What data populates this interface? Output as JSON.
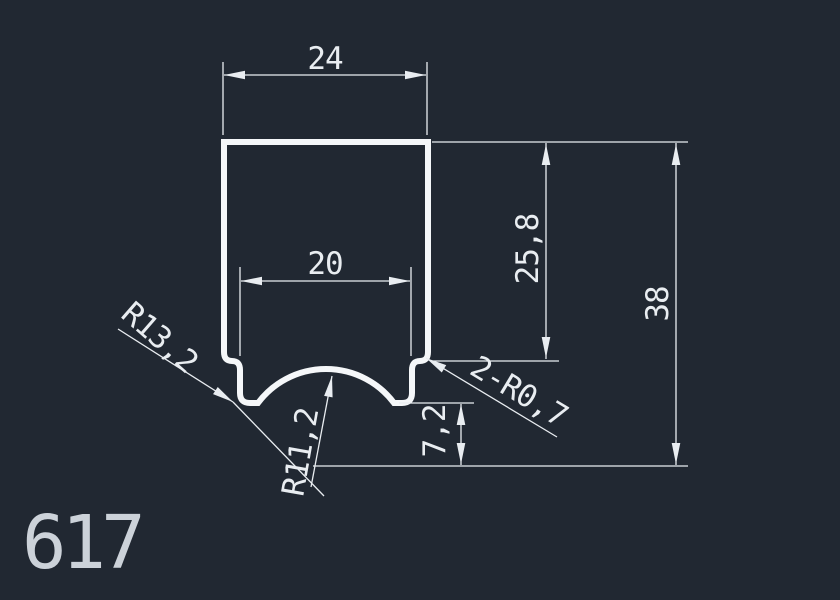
{
  "meta": {
    "description": "CAD technical drawing of an extruded profile cross-section on dark model space"
  },
  "theme": {
    "background": "#212832",
    "line": "#e9edf1",
    "profile_line": "#f5f7f9",
    "part_number_color": "#ccd2d9"
  },
  "part": {
    "number": "617"
  },
  "dimensions": {
    "overall_width": "24",
    "opening_width": "20",
    "depth_to_step": "25,8",
    "overall_height": "38",
    "lip_offset": "7,2",
    "radius_outer": "R13,2",
    "radius_groove": "R11,2",
    "fillets": "2-R0,7"
  }
}
